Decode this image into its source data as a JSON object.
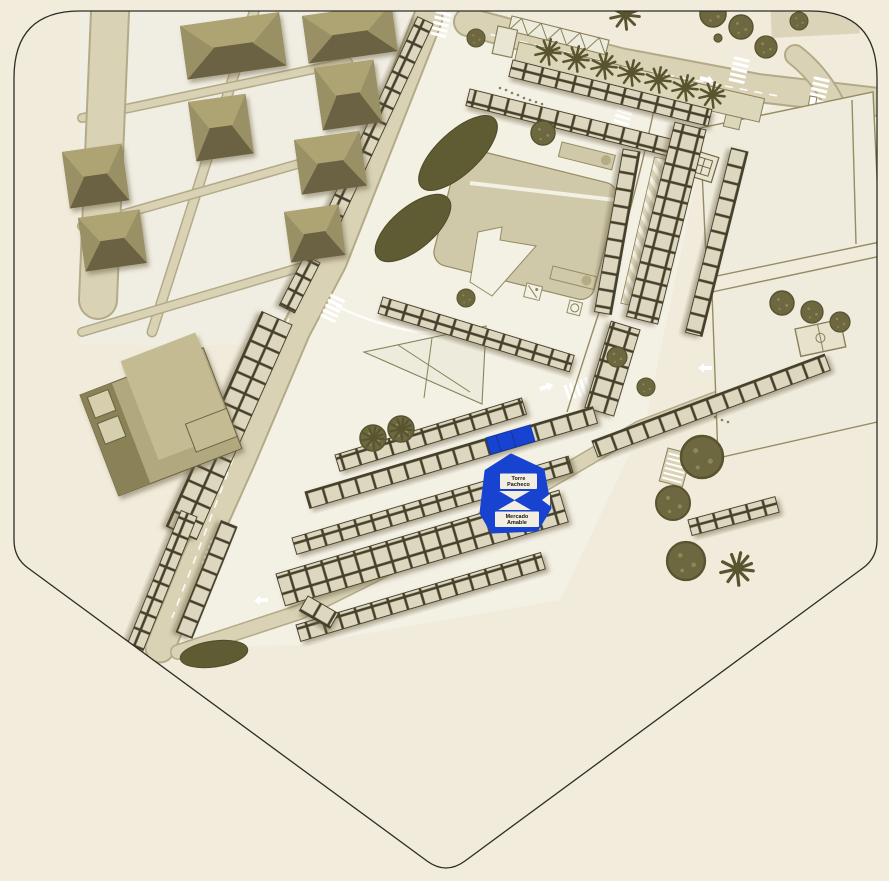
{
  "map": {
    "marker": {
      "top_line1": "Torre",
      "top_line2": "Pacheco",
      "bottom_line1": "Mercado",
      "bottom_line2": "Amable"
    },
    "colors": {
      "paper": "#f2ecdd",
      "ground": "#f1ebdb",
      "walk": "#f3f0e4",
      "district": "#f0eee2",
      "road": "#d9d2b5",
      "roadEdge": "#b3aa87",
      "plaza": "#cfc8a9",
      "plazaEdge": "#958c64",
      "stall": "#ddd7bf",
      "stallLine": "#45402a",
      "olive": "#8a815b",
      "oliveDark": "#6e6545",
      "roofLight": "#ada373",
      "roofMid": "#8f865c",
      "roofMid2": "#9a9066",
      "roofDark": "#6b6243",
      "tree": "#6e6840",
      "treeDark": "#585430",
      "hedge": "#5f5b33",
      "accent": "#1743d0",
      "accentDark": "#1238a8",
      "outline": "#2e2c26",
      "chip": "#f2eee1"
    }
  }
}
